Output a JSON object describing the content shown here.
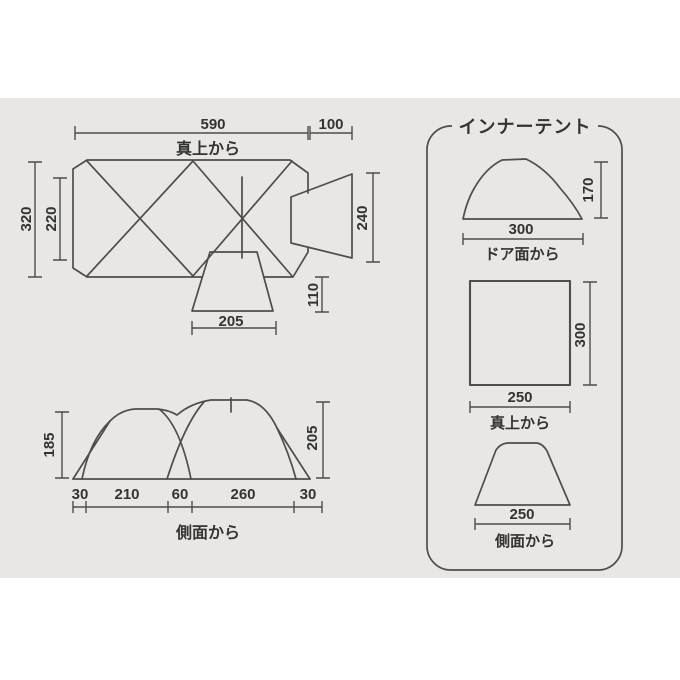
{
  "colors": {
    "page_bg": "#ffffff",
    "canvas_bg": "#e8e7e5",
    "line": "#4d4d4d",
    "text": "#333333"
  },
  "top_view": {
    "caption": "真上から",
    "dims": {
      "total_width": "590",
      "porch_width": "100",
      "total_depth": "320",
      "inner_depth": "220",
      "porch_depth": "240",
      "entrance_depth": "110",
      "entrance_width": "205"
    }
  },
  "side_view": {
    "caption": "側面から",
    "dims": {
      "left_height": "185",
      "right_height": "205",
      "segments": [
        "30",
        "210",
        "60",
        "260",
        "30"
      ]
    }
  },
  "inner_tent": {
    "title": "インナーテント",
    "door_view": {
      "caption": "ドア面から",
      "width": "300",
      "height": "170"
    },
    "top_view": {
      "caption": "真上から",
      "width": "250",
      "depth": "300"
    },
    "side_view": {
      "caption": "側面から",
      "width": "250"
    }
  }
}
